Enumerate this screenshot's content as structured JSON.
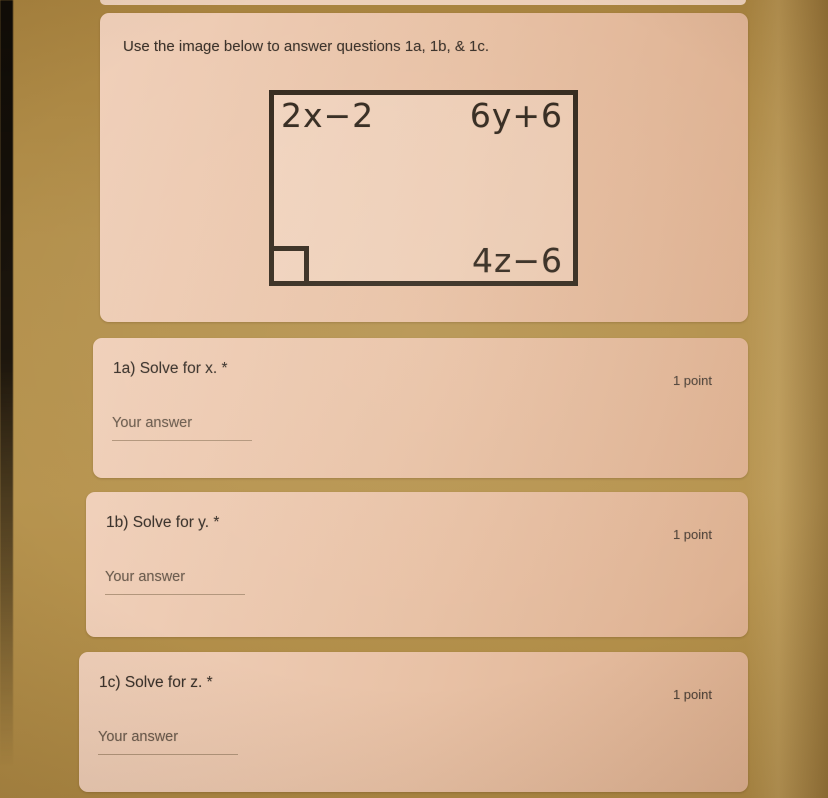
{
  "colors": {
    "background": "#b3904c",
    "card": "#e8c1a5",
    "figure_line": "#342a1e",
    "text_dark": "#3a322c",
    "text_muted": "#51453c",
    "underline": "#b2967c",
    "left_edge": "#0e0b07"
  },
  "intro_card": {
    "instruction": "Use the image below to answer questions 1a, 1b, & 1c.",
    "figure": {
      "top_left_label": "2x−2",
      "top_right_label": "6y+6",
      "bottom_right_label": "4z−6",
      "right_angle_marker": "right-angle-icon"
    }
  },
  "questions": [
    {
      "title": "1a) Solve for x. *",
      "points": "1 point",
      "answer_placeholder": "Your answer",
      "answer_value": ""
    },
    {
      "title": "1b) Solve for y. *",
      "points": "1 point",
      "answer_placeholder": "Your answer",
      "answer_value": ""
    },
    {
      "title": "1c) Solve for z. *",
      "points": "1 point",
      "answer_placeholder": "Your answer",
      "answer_value": ""
    }
  ]
}
